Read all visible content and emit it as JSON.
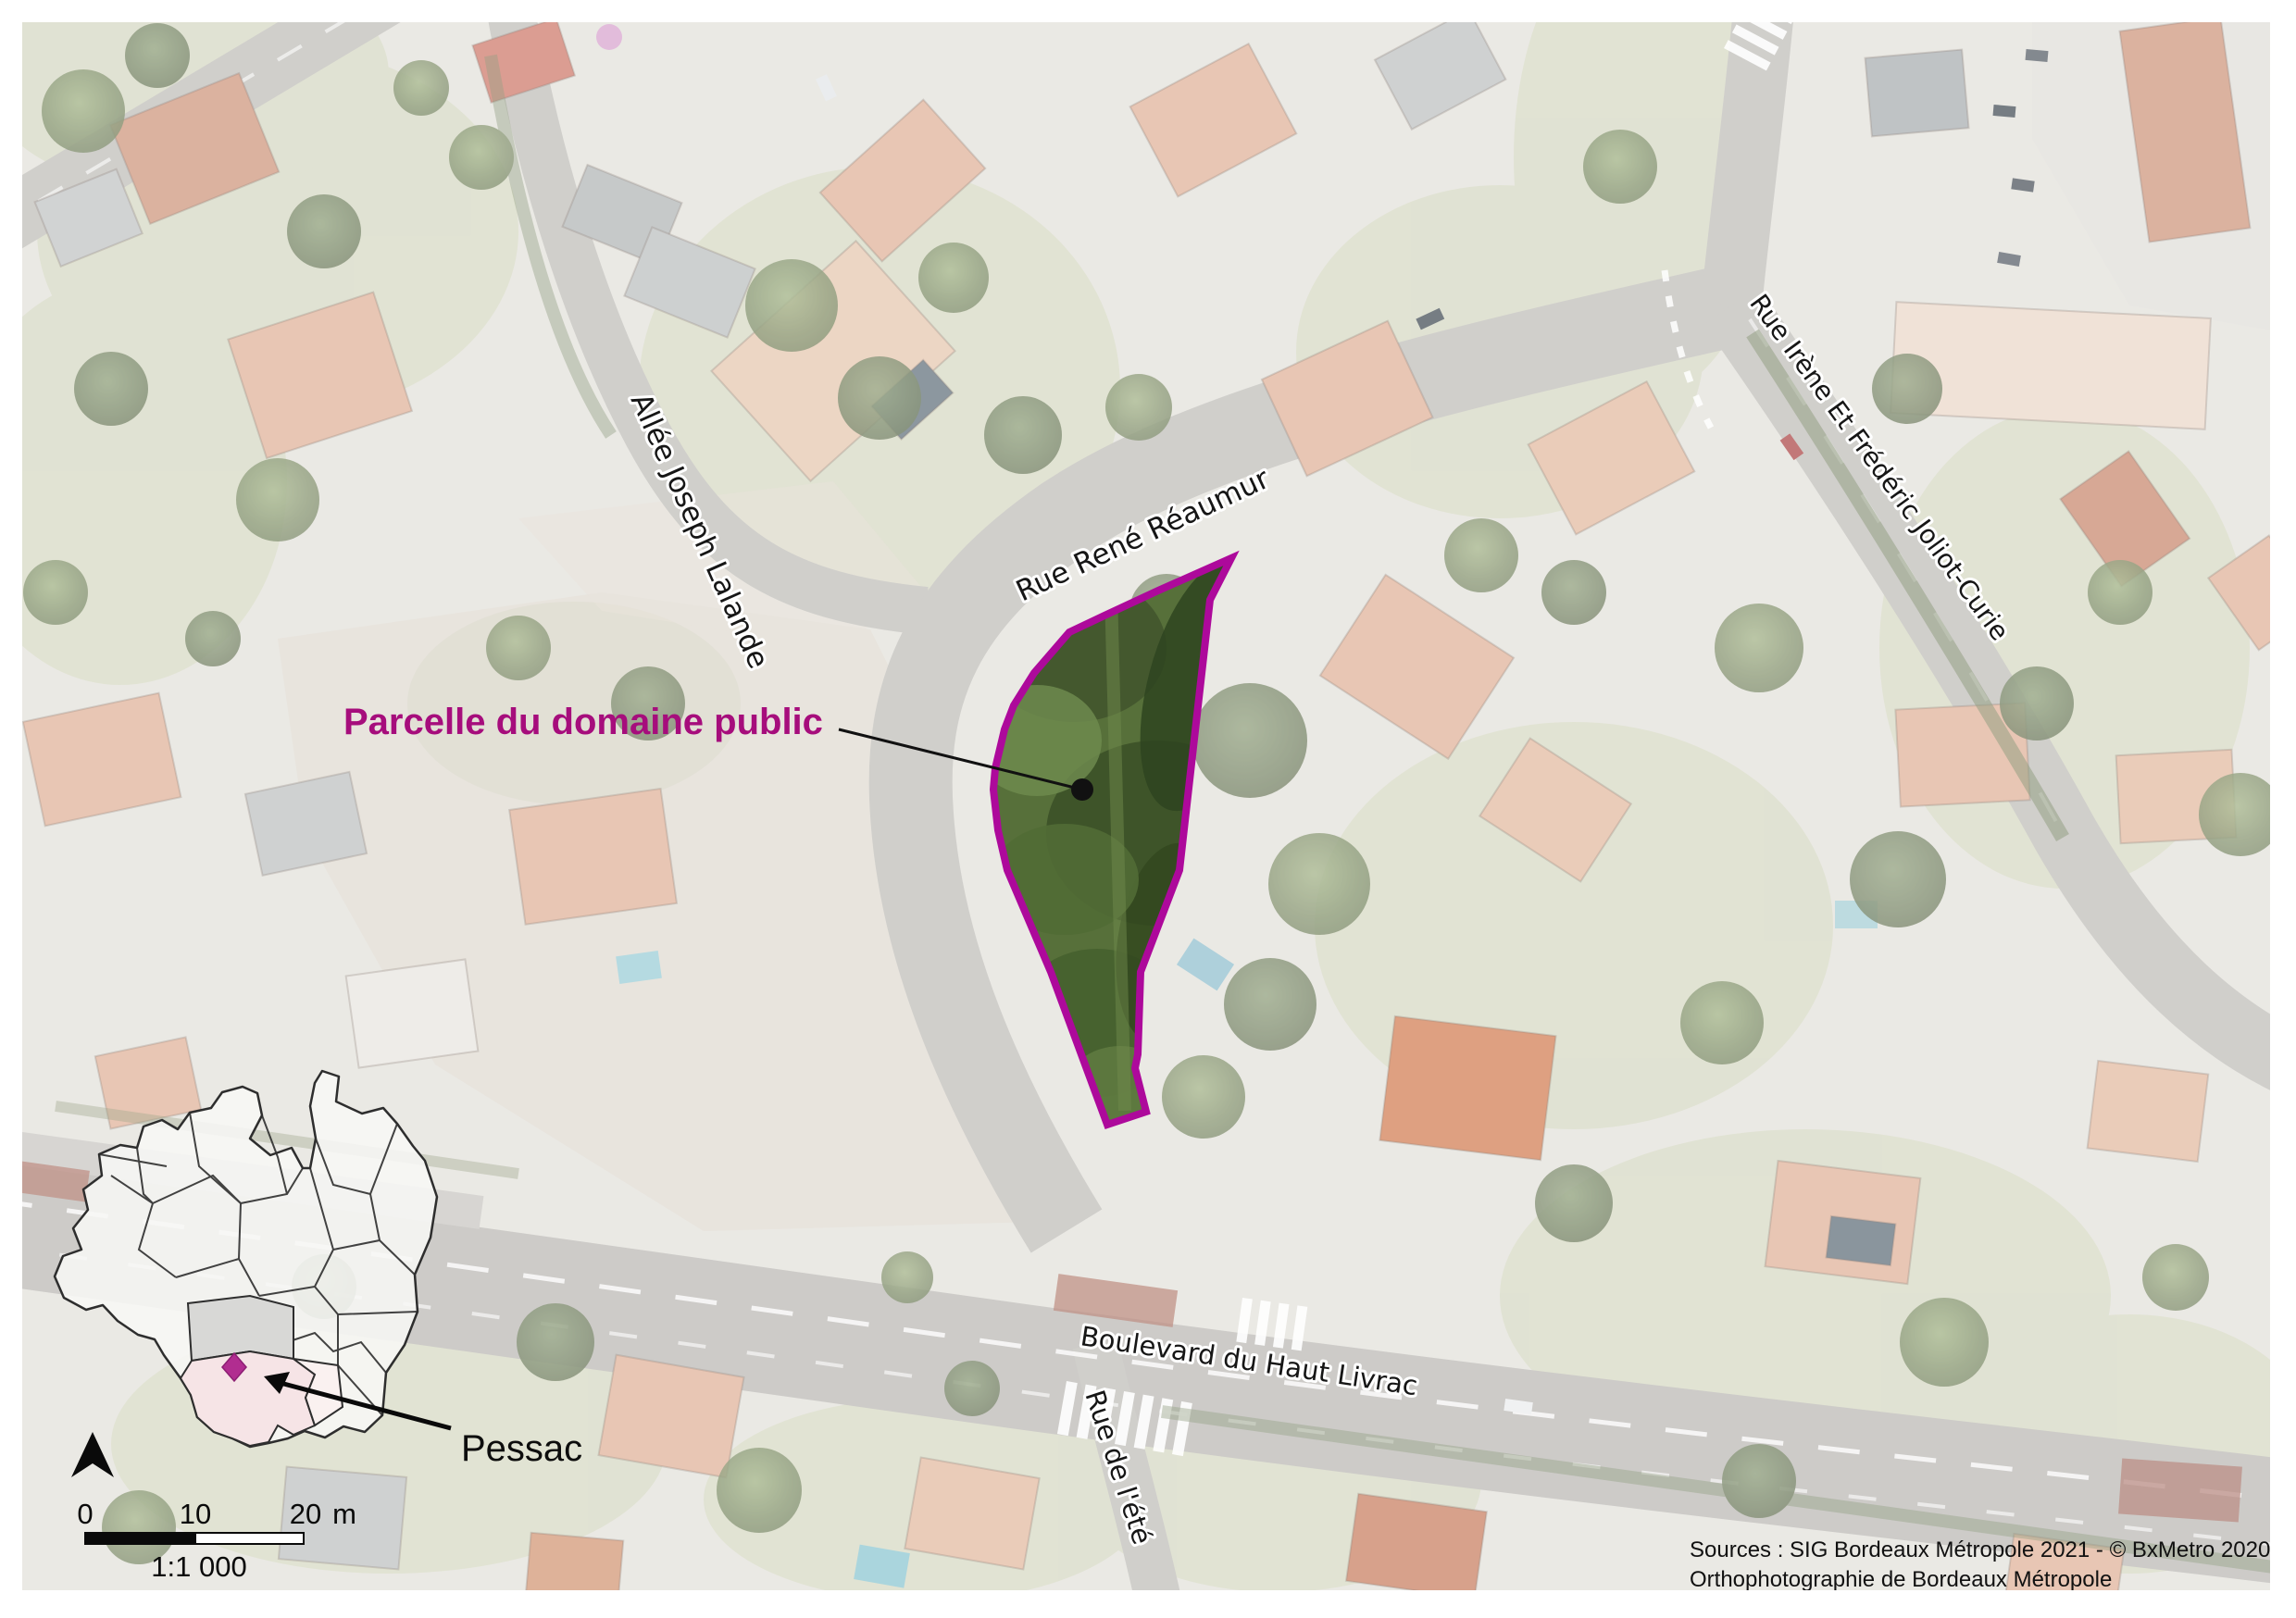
{
  "street_labels": {
    "allee_joseph_lalande": "Allée Joseph Lalande",
    "rue_rene_reaumur": "Rue René Réaumur",
    "rue_irene_joliot_curie": "Rue Irène Et Frédéric Joliot-Curie",
    "boulevard_haut_livrac": "Boulevard du Haut Livrac",
    "rue_de_lete": "Rue de l'été"
  },
  "annotation": {
    "parcel_label": "Parcelle du domaine public",
    "label_color": "#a60d7c",
    "outline_color": "#ad099b"
  },
  "inset": {
    "commune_label": "Pessac",
    "highlight_color": "#f6e4e6",
    "marker_color": "#b12d90"
  },
  "scale_bar": {
    "tick_0": "0",
    "tick_10": "10",
    "tick_20": "20",
    "unit": "m",
    "ratio": "1:1 000"
  },
  "sources": {
    "line1": "Sources : SIG Bordeaux Métropole 2021 - © BxMetro 2020,",
    "line2": "Orthophotographie de Bordeaux Métropole"
  }
}
